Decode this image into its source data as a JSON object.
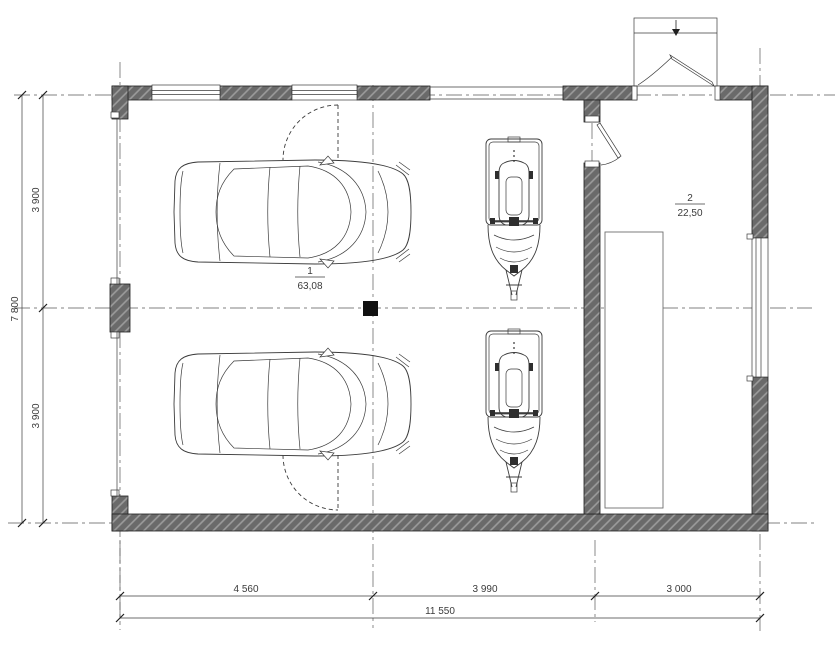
{
  "plan_title": "garage floor plan",
  "rooms": [
    {
      "number": "1",
      "area": "63,08"
    },
    {
      "number": "2",
      "area": "22,50"
    }
  ],
  "dimensions": {
    "bottom": [
      "4 560",
      "3 990",
      "3 000"
    ],
    "bottom_total": "11 550",
    "left": [
      "3 900",
      "3 900"
    ],
    "left_total": "7 800"
  },
  "colors": {
    "background": "#ffffff",
    "wall_fill": "#6a6a6a",
    "wall_hatch": "#9c9c9c",
    "line": "#3b3b3b",
    "centerline": "#5a5a5a",
    "column_fill": "#111111"
  }
}
